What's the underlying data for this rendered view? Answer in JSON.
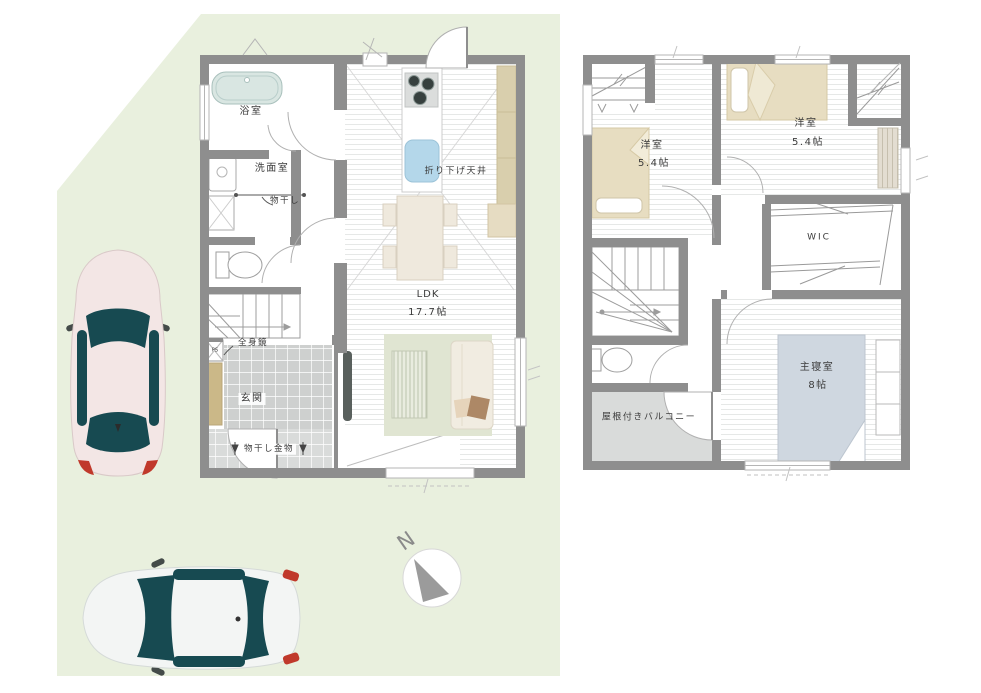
{
  "site": {
    "compass_label": "N"
  },
  "floor1": {
    "rooms": {
      "bath": "浴室",
      "washroom": "洗面室",
      "entrance": "玄関",
      "ldk_name": "LDK",
      "ldk_size": "17.7帖"
    },
    "annotations": {
      "laundry_pole": "物干し",
      "lowered_ceiling": "折り下げ天井",
      "full_mirror": "全身鏡",
      "pipe_space": "PS",
      "laundry_hardware": "物干し金物"
    }
  },
  "floor2": {
    "bedrooms": [
      {
        "name": "洋室",
        "size": "5.4帖"
      },
      {
        "name": "洋室",
        "size": "5.4帖"
      }
    ],
    "wic": "WIC",
    "master": {
      "name": "主寝室",
      "size": "8帖"
    },
    "balcony": "屋根付きバルコニー"
  },
  "colors": {
    "site_green": "#e9f0de",
    "wall_gray": "#8e8e8e",
    "bed_beige": "#e7ddc1",
    "master_bed_blue": "#cfd7e0",
    "balcony_gray": "#d9dbda",
    "entrance_tile_gray": "#ced0cf",
    "kitchen_sink_blue": "#b4d7ea",
    "rug_green": "#e0e5d2",
    "car_glass_teal": "#174a51",
    "car1_body_pink": "#f3e6e5",
    "car2_body_white": "#f3f5f4"
  }
}
